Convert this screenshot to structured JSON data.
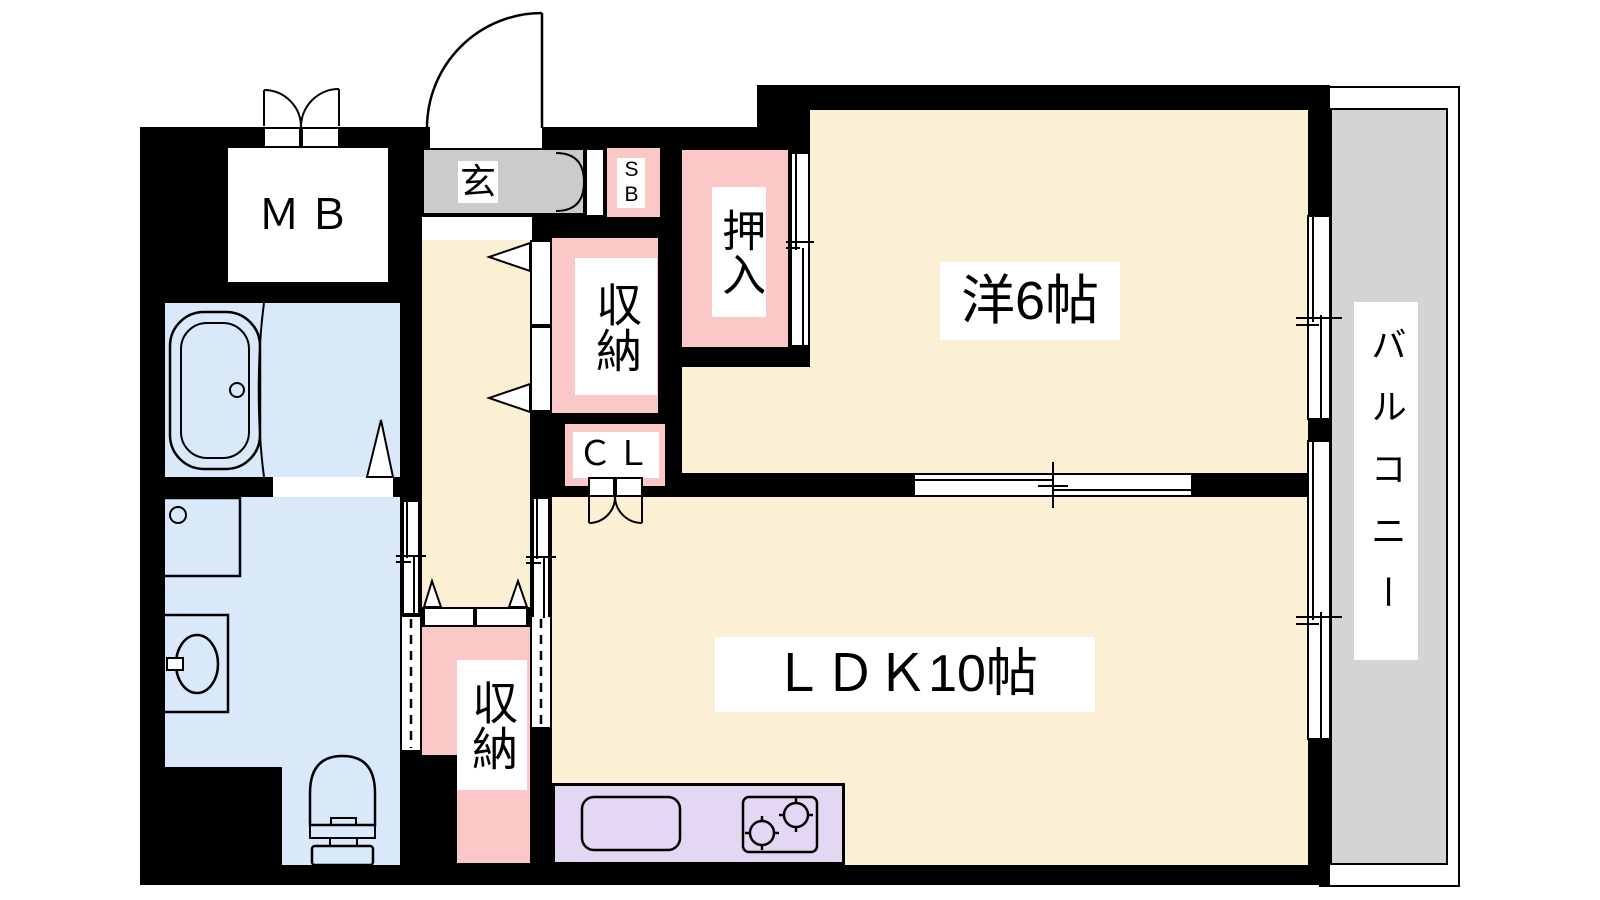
{
  "title": "1LDK apartment floor plan",
  "colors": {
    "wall": "#000000",
    "cream": "#FBF0D3",
    "pink": "#FBC7C7",
    "blue": "#DAE9FA",
    "genkan-gray": "#CBCBCB",
    "balcony-gray": "#D4D4D4",
    "kitchen-lavender": "#E4D7F3",
    "label-bg": "#FFFFFF",
    "text": "#000000"
  },
  "rooms": {
    "western": {
      "label": "洋6帖"
    },
    "ldk": {
      "label": "ＬＤＫ10帖"
    },
    "balcony": {
      "label": "バルコニー"
    },
    "entrance": {
      "label": "玄"
    },
    "meter_box": {
      "label": "ＭＢ"
    },
    "shoe_box": {
      "label": "SB"
    },
    "oshiire": {
      "label": "押入"
    },
    "storage_upper": {
      "label": "収納"
    },
    "storage_lower": {
      "label": "収納"
    },
    "closet": {
      "label": "ＣＬ"
    }
  },
  "fixtures": [
    "bathtub",
    "washing-machine-pan",
    "washbasin",
    "toilet",
    "kitchen-sink",
    "gas-stove",
    "entrance-door",
    "sliding-doors",
    "folding-doors",
    "windows"
  ]
}
